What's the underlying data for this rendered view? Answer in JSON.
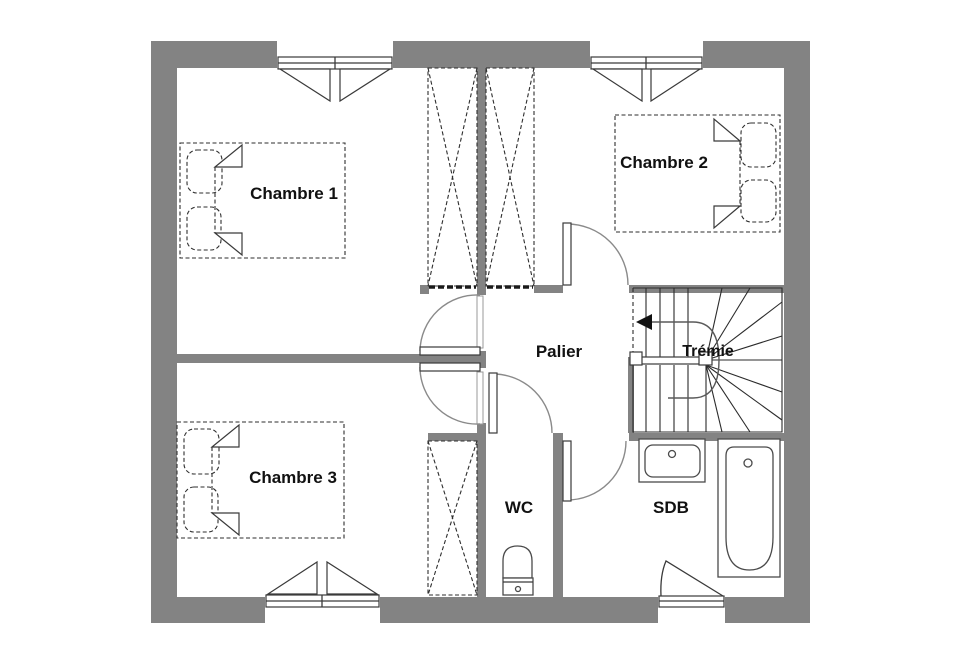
{
  "plan": {
    "title": "Plan d'étage",
    "rooms": {
      "chambre1": {
        "label": "Chambre 1"
      },
      "chambre2": {
        "label": "Chambre 2"
      },
      "chambre3": {
        "label": "Chambre 3"
      },
      "palier": {
        "label": "Palier"
      },
      "tremie": {
        "label": "Trémie"
      },
      "wc": {
        "label": "WC"
      },
      "sdb": {
        "label": "SDB"
      }
    },
    "colors": {
      "wall": "#838383",
      "label": "#111111",
      "background": "#ffffff"
    }
  }
}
